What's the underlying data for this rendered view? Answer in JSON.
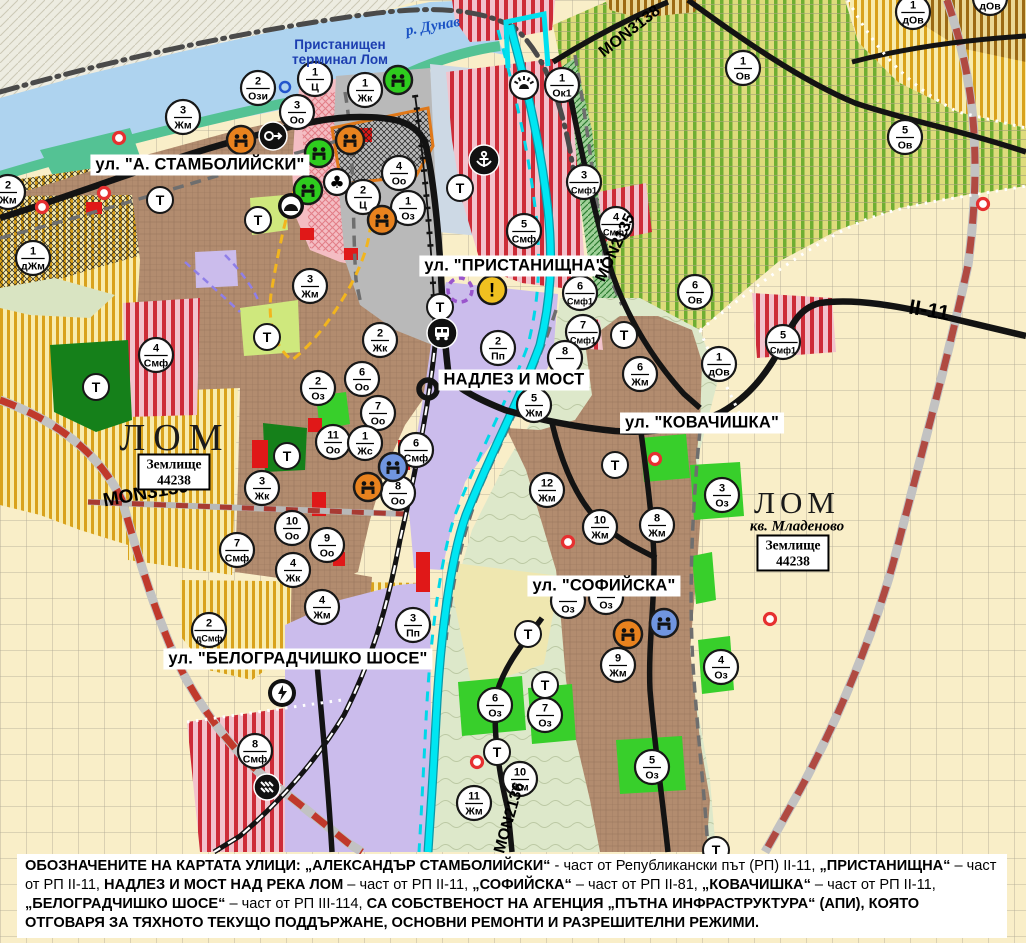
{
  "map": {
    "width": 1026,
    "height": 943,
    "colors": {
      "water": "#aed3ef",
      "river_lom": "#00e6f2",
      "urban": "#b28c6f",
      "gold_zone": "#d9a21c",
      "vineyard": "#6fae33",
      "red_stripe": "#cd2c38",
      "lavender": "#cbbcec",
      "park_green": "#15801a",
      "oz_green": "#38cf2b",
      "road_black": "#131313",
      "road_red_dash": "#c0392b",
      "marker_bg": "#ffffff"
    },
    "street_labels": [
      {
        "text": "ул. \"А. СТАМБОЛИЙСКИ\"",
        "x": 200,
        "y": 165
      },
      {
        "text": "ул. \"ПРИСТАНИЩНА\"",
        "x": 514,
        "y": 266
      },
      {
        "text": "НАДЛЕЗ И МОСТ",
        "x": 514,
        "y": 380
      },
      {
        "text": "ул. \"КОВАЧИШКА\"",
        "x": 702,
        "y": 423
      },
      {
        "text": "ул. \"СОФИЙСКА\"",
        "x": 604,
        "y": 586
      },
      {
        "text": "ул. \"БЕЛОГРАДЧИШКО ШОСЕ\"",
        "x": 298,
        "y": 659
      }
    ],
    "road_labels": [
      {
        "text": "MON3139",
        "x": 146,
        "y": 494,
        "rot": -10,
        "size": 19
      },
      {
        "text": "MON3138",
        "x": 630,
        "y": 32,
        "rot": -38,
        "size": 16
      },
      {
        "text": "MON2135",
        "x": 616,
        "y": 248,
        "rot": -65,
        "size": 16
      },
      {
        "text": "MON2136",
        "x": 510,
        "y": 818,
        "rot": -74,
        "size": 16
      },
      {
        "text": "II-11",
        "x": 929,
        "y": 311,
        "rot": 10,
        "size": 21
      }
    ],
    "place_labels": [
      {
        "style": "river",
        "text": "р. Дунав",
        "x": 433,
        "y": 27,
        "rot": -10
      },
      {
        "style": "terminal",
        "lines": [
          "Пристанищен",
          "терминал Лом"
        ],
        "x": 340,
        "y": 52
      },
      {
        "style": "city",
        "text": "ЛОМ",
        "x": 175,
        "y": 438,
        "size": 38,
        "spacing": 8
      },
      {
        "style": "zem",
        "lines": [
          "Землище",
          "44238"
        ],
        "x": 174,
        "y": 472
      },
      {
        "style": "city",
        "text": "ЛОМ",
        "x": 797,
        "y": 503,
        "size": 31,
        "spacing": 5
      },
      {
        "style": "kv",
        "text": "кв. Младеново",
        "x": 797,
        "y": 527
      },
      {
        "style": "zem",
        "lines": [
          "Землище",
          "44238"
        ],
        "x": 793,
        "y": 553
      }
    ],
    "zone_markers": [
      [
        8,
        192,
        "2",
        "Жм"
      ],
      [
        33,
        258,
        "1",
        "дЖм"
      ],
      [
        183,
        117,
        "3",
        "Жм"
      ],
      [
        258,
        88,
        "2",
        "Ози"
      ],
      [
        315,
        79,
        "1",
        "Ц"
      ],
      [
        365,
        90,
        "1",
        "Жк"
      ],
      [
        297,
        112,
        "3",
        "Оо"
      ],
      [
        399,
        173,
        "4",
        "Оо"
      ],
      [
        363,
        197,
        "2",
        "Ц"
      ],
      [
        408,
        208,
        "1",
        "Оз"
      ],
      [
        310,
        286,
        "3",
        "Жм"
      ],
      [
        562,
        85,
        "1",
        "Ок1"
      ],
      [
        584,
        182,
        "3",
        "Смф1"
      ],
      [
        616,
        224,
        "4",
        "Смф1"
      ],
      [
        524,
        231,
        "5",
        "Смф"
      ],
      [
        580,
        293,
        "6",
        "Смф1"
      ],
      [
        583,
        332,
        "7",
        "Смф1"
      ],
      [
        743,
        68,
        "1",
        "Ов"
      ],
      [
        905,
        137,
        "5",
        "Ов"
      ],
      [
        913,
        12,
        "1",
        "дОв"
      ],
      [
        990,
        -2,
        "1",
        "дОв"
      ],
      [
        695,
        292,
        "6",
        "Ов"
      ],
      [
        719,
        364,
        "1",
        "дОв"
      ],
      [
        783,
        342,
        "5",
        "Смф1"
      ],
      [
        156,
        355,
        "4",
        "Смф"
      ],
      [
        318,
        388,
        "2",
        "Оз"
      ],
      [
        333,
        442,
        "11",
        "Оо"
      ],
      [
        262,
        488,
        "3",
        "Жк"
      ],
      [
        292,
        528,
        "10",
        "Оо"
      ],
      [
        327,
        545,
        "9",
        "Оо"
      ],
      [
        237,
        550,
        "7",
        "Смф"
      ],
      [
        293,
        570,
        "4",
        "Жк"
      ],
      [
        322,
        607,
        "4",
        "Жм"
      ],
      [
        209,
        630,
        "2",
        "дСмф"
      ],
      [
        255,
        751,
        "8",
        "Смф"
      ],
      [
        380,
        340,
        "2",
        "Жк"
      ],
      [
        362,
        379,
        "6",
        "Оо"
      ],
      [
        378,
        413,
        "7",
        "Оо"
      ],
      [
        365,
        443,
        "1",
        "Жс"
      ],
      [
        416,
        450,
        "6",
        "Смф"
      ],
      [
        398,
        493,
        "8",
        "Оо"
      ],
      [
        498,
        348,
        "2",
        "Пп"
      ],
      [
        534,
        405,
        "5",
        "Жм"
      ],
      [
        565,
        358,
        "8",
        ""
      ],
      [
        547,
        490,
        "12",
        "Жм"
      ],
      [
        600,
        527,
        "10",
        "Жм"
      ],
      [
        657,
        525,
        "8",
        "Жм"
      ],
      [
        640,
        374,
        "6",
        "Жм"
      ],
      [
        722,
        495,
        "3",
        "Оз"
      ],
      [
        413,
        625,
        "3",
        "Пп"
      ],
      [
        568,
        601,
        "",
        "Оз"
      ],
      [
        606,
        597,
        "",
        "Оз"
      ],
      [
        618,
        665,
        "9",
        "Жм"
      ],
      [
        495,
        705,
        "6",
        "Оз"
      ],
      [
        545,
        715,
        "7",
        "Оз"
      ],
      [
        520,
        779,
        "10",
        "Жм"
      ],
      [
        474,
        803,
        "11",
        "Жм"
      ],
      [
        652,
        767,
        "5",
        "Оз"
      ],
      [
        721,
        667,
        "4",
        "Оз"
      ]
    ],
    "t_markers": [
      [
        160,
        200
      ],
      [
        258,
        220
      ],
      [
        267,
        337
      ],
      [
        96,
        387
      ],
      [
        287,
        456
      ],
      [
        460,
        188
      ],
      [
        440,
        307
      ],
      [
        624,
        335
      ],
      [
        615,
        465
      ],
      [
        528,
        634
      ],
      [
        545,
        685
      ],
      [
        497,
        752
      ],
      [
        716,
        850
      ]
    ],
    "poi": [
      {
        "x": 241,
        "y": 140,
        "type": "culture",
        "color": "orange"
      },
      {
        "x": 350,
        "y": 140,
        "type": "culture",
        "color": "orange"
      },
      {
        "x": 382,
        "y": 220,
        "type": "culture",
        "color": "orange"
      },
      {
        "x": 368,
        "y": 487,
        "type": "culture",
        "color": "orange"
      },
      {
        "x": 628,
        "y": 634,
        "type": "culture",
        "color": "orange"
      },
      {
        "x": 398,
        "y": 80,
        "type": "culture",
        "color": "green"
      },
      {
        "x": 319,
        "y": 153,
        "type": "culture",
        "color": "green"
      },
      {
        "x": 308,
        "y": 190,
        "type": "culture",
        "color": "green"
      },
      {
        "x": 393,
        "y": 467,
        "type": "culture",
        "color": "blue"
      },
      {
        "x": 664,
        "y": 623,
        "type": "culture",
        "color": "blue"
      },
      {
        "x": 337,
        "y": 182,
        "type": "club"
      },
      {
        "x": 291,
        "y": 206,
        "type": "mound"
      },
      {
        "x": 273,
        "y": 136,
        "type": "arrow"
      },
      {
        "x": 484,
        "y": 160,
        "type": "anchor"
      },
      {
        "x": 524,
        "y": 85,
        "type": "sun"
      },
      {
        "x": 442,
        "y": 333,
        "type": "bus"
      },
      {
        "x": 282,
        "y": 693,
        "type": "lightning"
      },
      {
        "x": 267,
        "y": 787,
        "type": "station"
      },
      {
        "x": 492,
        "y": 290,
        "type": "warning"
      },
      {
        "x": 460,
        "y": 290,
        "type": "violet-circle"
      },
      {
        "x": 285,
        "y": 87,
        "type": "blue-ring"
      }
    ],
    "red_rings": [
      [
        119,
        138
      ],
      [
        104,
        193
      ],
      [
        42,
        207
      ],
      [
        568,
        542
      ],
      [
        655,
        459
      ],
      [
        477,
        762
      ],
      [
        770,
        619
      ],
      [
        983,
        204
      ]
    ]
  },
  "legend_note": {
    "segments": [
      {
        "b": 1,
        "t": "ОБОЗНАЧЕНИТЕ НА КАРТАТА УЛИЦИ: „АЛЕКСАНДЪР СТАМБОЛИЙСКИ“"
      },
      {
        "b": 0,
        "t": " - част от Републикански път (РП) II-11, "
      },
      {
        "b": 1,
        "t": "„ПРИСТАНИЩНА“"
      },
      {
        "b": 0,
        "t": " – част от РП II-11, "
      },
      {
        "b": 1,
        "t": "НАДЛЕЗ И МОСТ НАД РЕКА ЛОМ"
      },
      {
        "b": 0,
        "t": " – част от РП II-11, "
      },
      {
        "b": 1,
        "t": "„СОФИЙСКА“"
      },
      {
        "b": 0,
        "t": " – част от РП II-81, "
      },
      {
        "b": 1,
        "t": "„КОВАЧИШКА“"
      },
      {
        "b": 0,
        "t": " – част от РП II-11, "
      },
      {
        "b": 1,
        "t": "„БЕЛОГРАДЧИШКО ШОСЕ“"
      },
      {
        "b": 0,
        "t": " – част от РП III-114, "
      },
      {
        "b": 1,
        "t": "СА СОБСТВЕНОСТ НА АГЕНЦИЯ „ПЪТНА ИНФРАСТРУКТУРА“ (АПИ), КОЯТО ОТГОВАРЯ ЗА ТЯХНОТО ТЕКУЩО ПОДДЪРЖАНЕ, ОСНОВНИ РЕМОНТИ И РАЗРЕШИТЕЛНИ РЕЖИМИ."
      }
    ]
  }
}
